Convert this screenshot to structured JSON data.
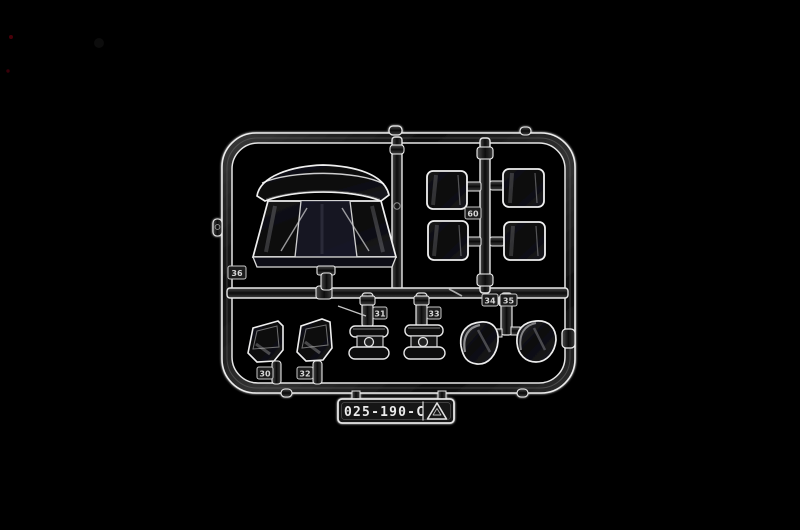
{
  "photo": {
    "background_color": "#000000",
    "subject": "clear plastic model kit sprue",
    "plastic_highlight_color": "#ececec",
    "tube_core_color": "#161616",
    "glass_tint_color": "#171728"
  },
  "label": {
    "code": "025-190-C",
    "icon": "recycling-triangle-icon"
  },
  "tags": {
    "frame_corner": "36",
    "windows_runner": "60",
    "quarter_left": "30",
    "quarter_right": "32",
    "lens_left": "31",
    "lens_right": "33",
    "dome_left": "34",
    "dome_right": "35"
  }
}
